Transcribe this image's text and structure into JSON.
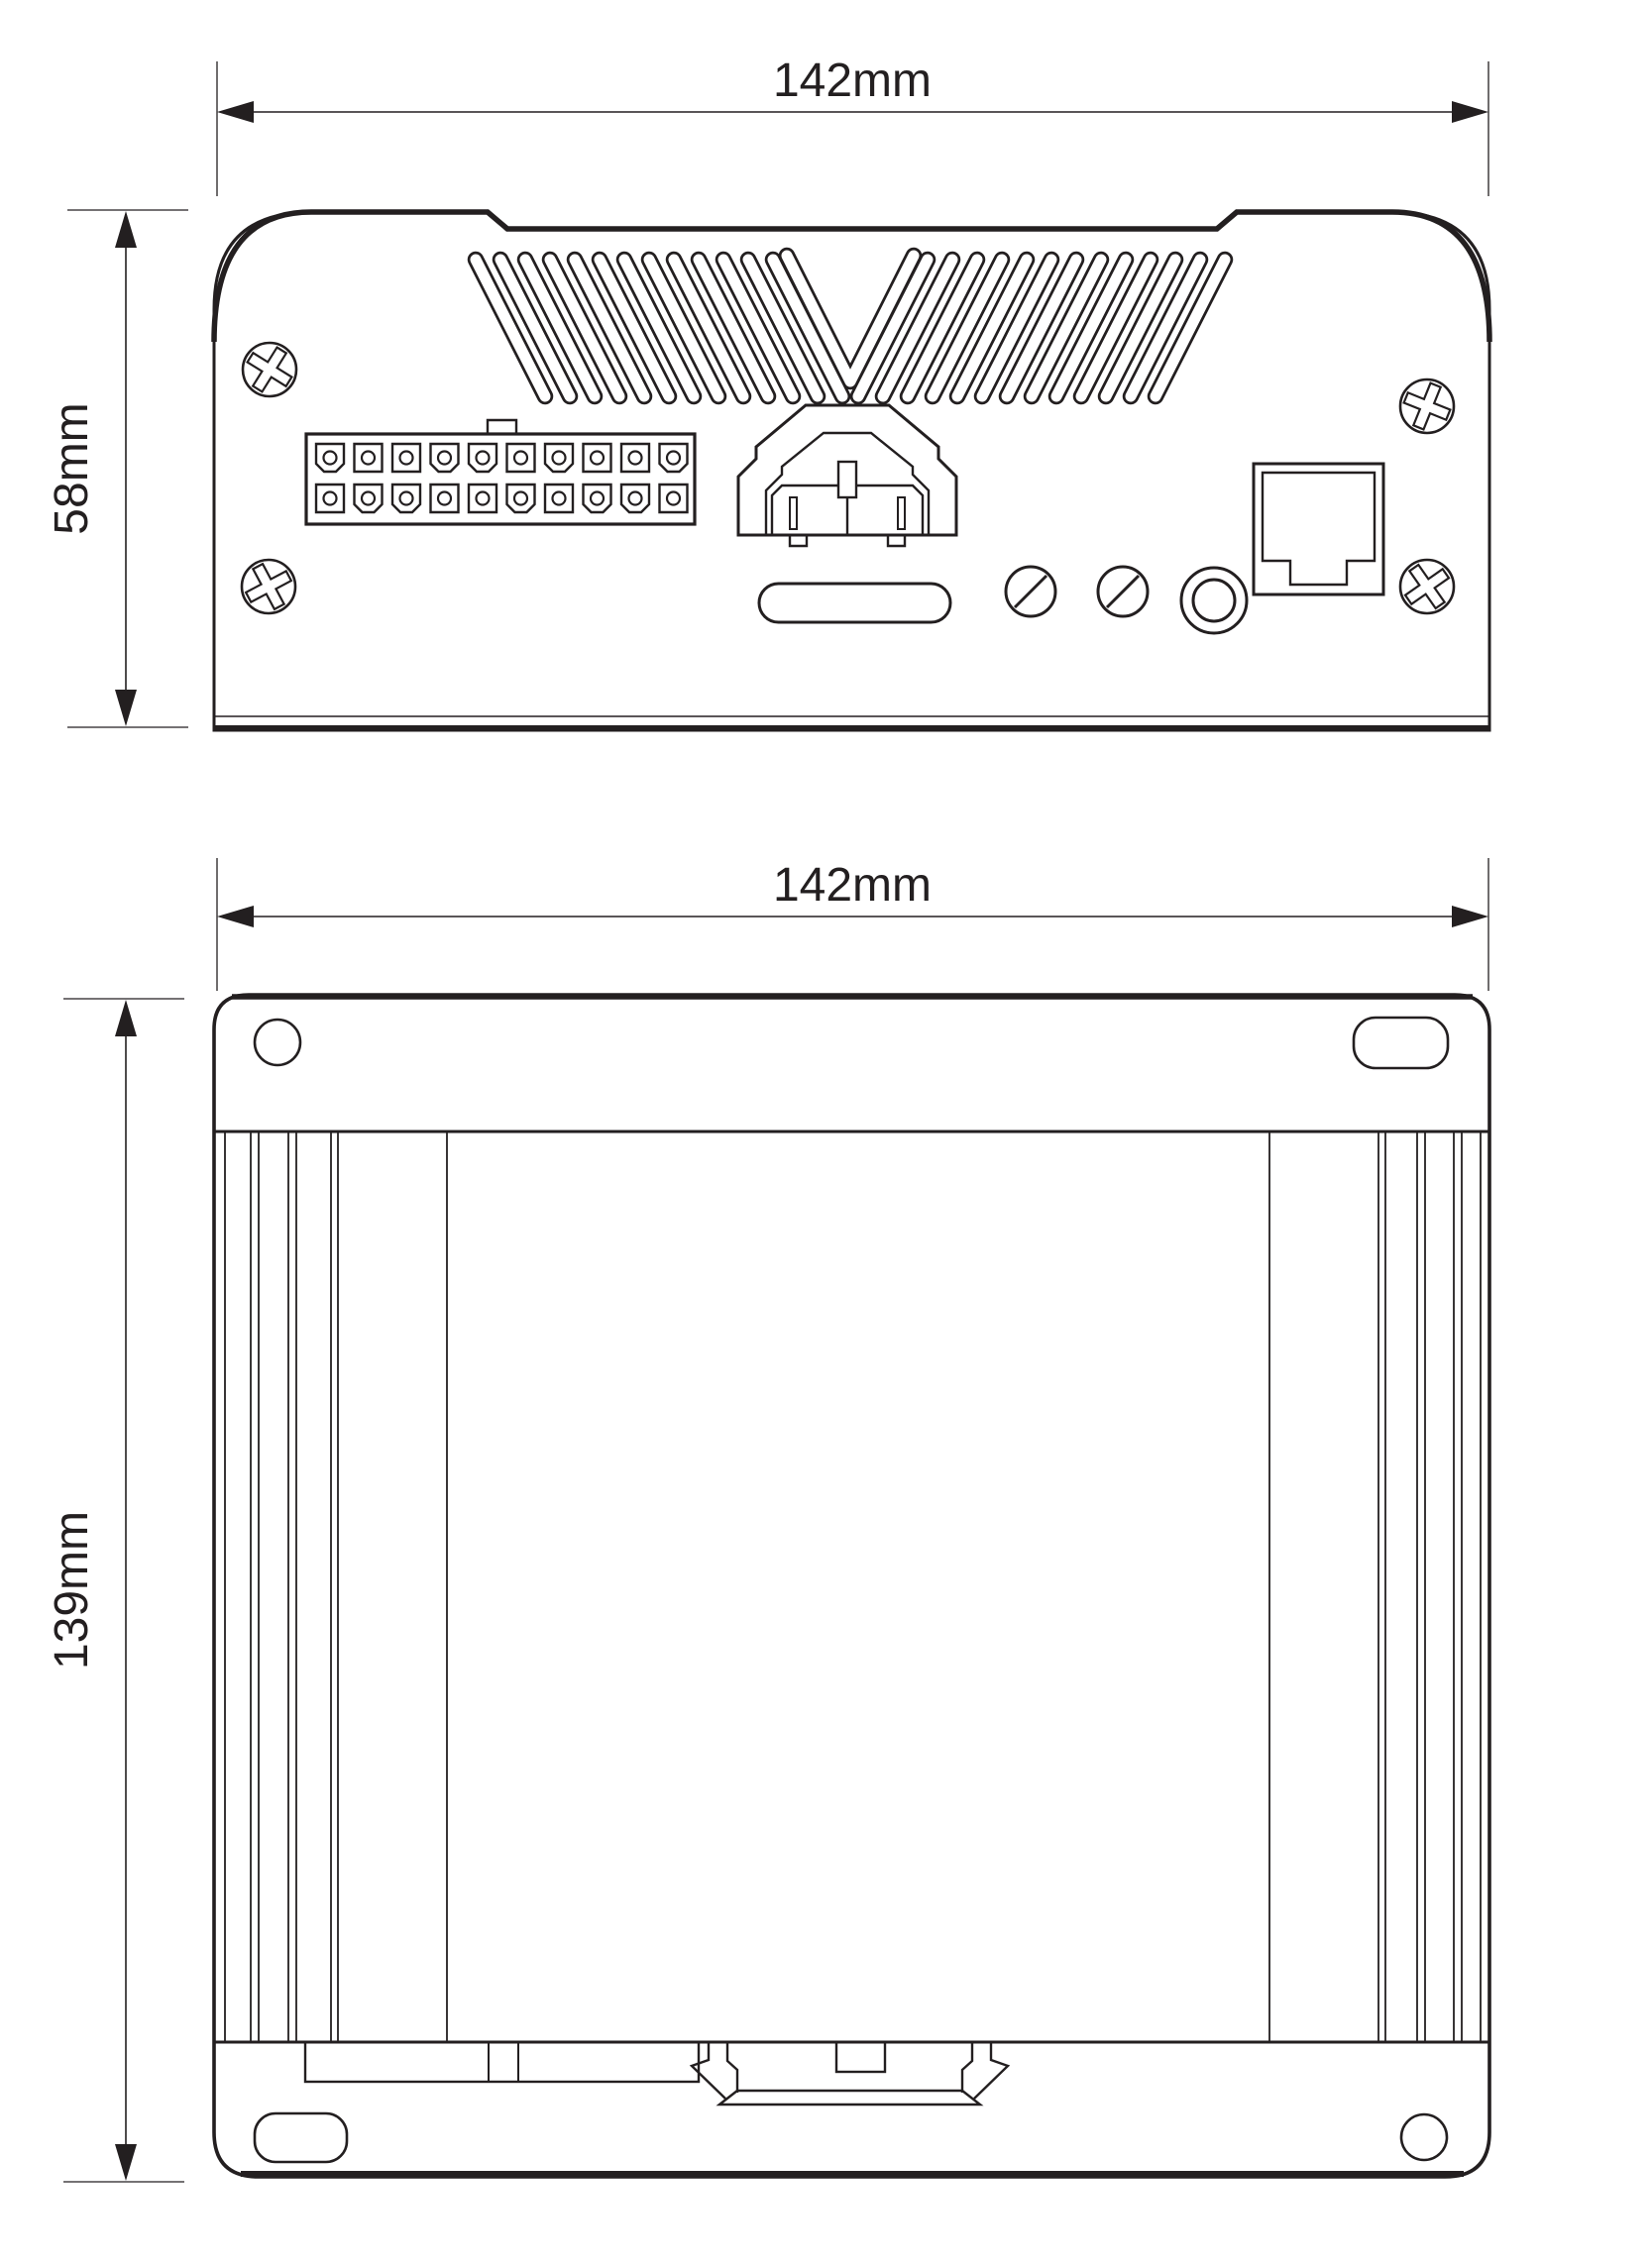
{
  "diagram": {
    "title": "device-dimension-drawing",
    "dimensions": {
      "front_width": "142mm",
      "front_height": "58mm",
      "top_width": "142mm",
      "top_depth": "139mm"
    },
    "colors": {
      "line": "#231f20",
      "background": "#ffffff"
    },
    "components": {
      "screws": "phillips-screw-icon",
      "vents": "chevron-vent-slots",
      "io_connector": "20-pin-connector",
      "power": "power-connector",
      "set_screws": "slotted-screw-icon",
      "antenna": "barrel-connector-icon",
      "network": "rj45-port",
      "mount": "din-rail-clip"
    }
  }
}
